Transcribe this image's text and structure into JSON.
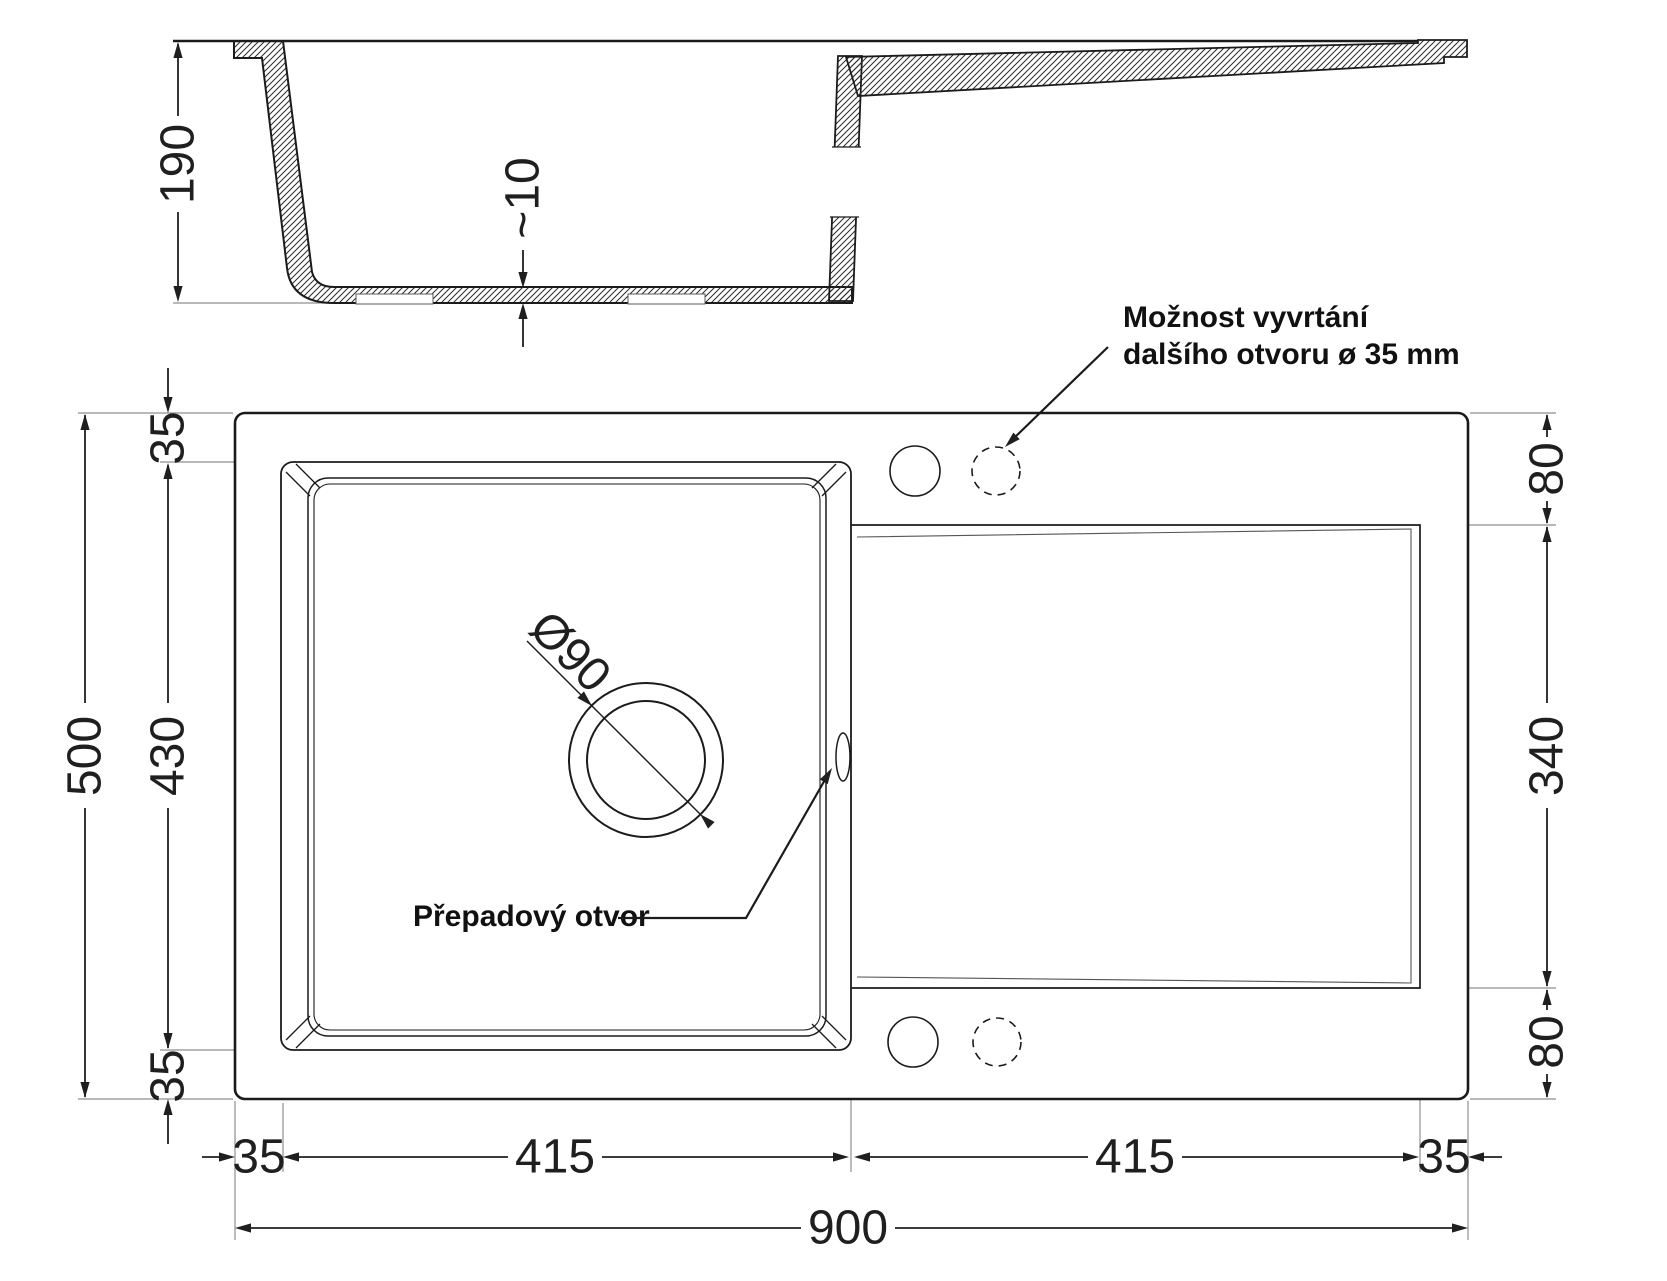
{
  "colors": {
    "line": "#1b1b1b",
    "thin_line": "#8f8f8f",
    "background": "#ffffff"
  },
  "side_view": {
    "depth_dim": "190",
    "bottom_thickness_dim": "~10"
  },
  "plan_view": {
    "left_dims": {
      "overall": "500",
      "top_margin": "35",
      "bowl_length": "430",
      "bottom_margin": "35"
    },
    "right_dims": {
      "top_margin": "80",
      "drainboard_length": "340",
      "bottom_margin": "80"
    },
    "bottom_dims": {
      "left_margin": "35",
      "bowl_width": "415",
      "drainboard_width": "415",
      "right_margin": "35",
      "overall": "900"
    },
    "drain_dim": "Ø90",
    "overflow_label": "Přepadový otvor",
    "extra_hole_note": {
      "line1": "Možnost vyvrtání",
      "line2": "dalšího otvoru ø 35 mm"
    }
  }
}
